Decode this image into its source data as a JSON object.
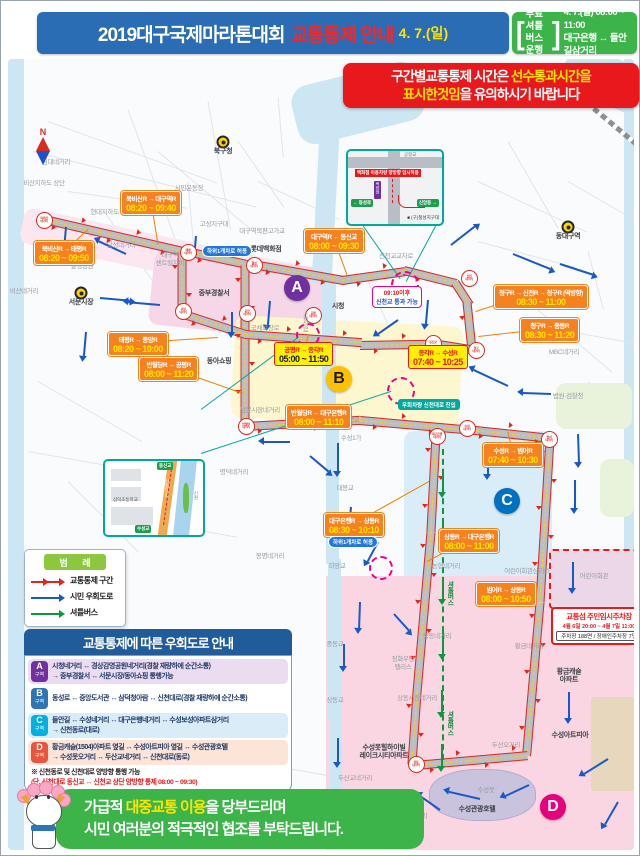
{
  "header": {
    "title": "2019대구국제마라톤대회",
    "subtitle": "교통통제 안내",
    "date": "4. 7.(일)",
    "shuttle": {
      "l1": "무료셔틀",
      "l2": "버스운행",
      "time": "4. 7.(일) 08:00 ~ 11:00",
      "route": "대구은행 ↔ 들안길삼거리",
      "bracket_open": "[",
      "bracket_close": "]"
    }
  },
  "notice": {
    "line1_pre": "구간별교통통제 시간은 ",
    "line1_hl": "선수통과시간을",
    "line2_hl": "표시한것임",
    "line2_post": "을 유의하시기 바랍니다"
  },
  "compass": {
    "n": "N",
    "s": "S"
  },
  "legend": {
    "title": "범 례",
    "items": [
      {
        "label": "교통통제 구간",
        "color": "#e0261f",
        "type": "double-arrow"
      },
      {
        "label": "시민 우회도로",
        "color": "#1a58c8",
        "type": "arrow"
      },
      {
        "label": "셔틀버스",
        "color": "#0a9a3c",
        "type": "arrow"
      }
    ]
  },
  "detour_box": {
    "title": "교통통제에 따른 우회도로 안내",
    "rows": [
      {
        "zone": "A",
        "zone_suffix": "구역",
        "badge": "#7030a0",
        "bg": "#ecdcf2",
        "lines": [
          "시청네거리 ↔ 경상감영공원네거리(경찰 재량하에 순간소통)",
          "→ 중부경찰서 ↔ 서문시장/동아쇼핑 통행가능"
        ]
      },
      {
        "zone": "B",
        "zone_suffix": "구역",
        "badge": "#2e75b6",
        "bg": "#ffffff",
        "lines": [
          "동성로 ↔ 중앙도서관 ↔ 삼덕청아람 ↔ 신천대로(경찰 재량하에 순간소통)"
        ]
      },
      {
        "zone": "C",
        "zone_suffix": "구역",
        "badge": "#00b0e0",
        "bg": "#d9ecf8",
        "lines": [
          "들안길 ↔ 수성네거리 ↔ 대구은행네거리 ↔ 수성보성아파트삼거리",
          "→ 신천동로(대로)"
        ]
      },
      {
        "zone": "D",
        "zone_suffix": "구역",
        "badge": "#e8553c",
        "bg": "#fde4d8",
        "lines": [
          "황금캐슬(1504)아파트 옆길 ↔ 수성아트피아 옆길 ↔ 수성관광호텔",
          "→ 수성못오거리 ↔ 두산교네거리 ↔ 신천대로(동로)"
        ]
      }
    ],
    "note_line1": "※ 신천동로 및 신천대로 양방향 통행 가능",
    "note_line2": "(단, 신천대로 동신교 ↔ 신천교 상단 양방향 통제 08:00 ~ 09:30)"
  },
  "footer": {
    "line1_pre": "가급적 ",
    "line1_hl": "대중교통 이용",
    "line1_post": "을 당부드리며",
    "line2": "시민 여러분의 적극적인 협조를 부탁드립니다."
  },
  "map": {
    "zone_letters": [
      {
        "letter": "A",
        "x": 289,
        "y": 287,
        "bg": "#7030a0",
        "fg": "#ffffff"
      },
      {
        "letter": "B",
        "x": 331,
        "y": 378,
        "bg": "#ffc000",
        "fg": "#1a1a1a"
      },
      {
        "letter": "C",
        "x": 499,
        "y": 500,
        "bg": "#0070c0",
        "fg": "#ffffff"
      },
      {
        "letter": "D",
        "x": 545,
        "y": 806,
        "bg": "#e6007e",
        "fg": "#ffffff"
      }
    ],
    "time_labels": [
      {
        "route": "북비산R → 대구역R",
        "time": "08:20 ~ 09:40",
        "x": 113,
        "y": 190,
        "v": "o",
        "tx": 150,
        "ty": 243
      },
      {
        "route": "북비산R → 태평R",
        "time": "08:20 ~ 09:50",
        "x": 26,
        "y": 240,
        "v": "o",
        "tx": 80,
        "ty": 228
      },
      {
        "route": "대구역R ← 동신교",
        "time": "08:00 ~ 09:30",
        "x": 296,
        "y": 228,
        "v": "o",
        "tx": 340,
        "ty": 276
      },
      {
        "route": "태평R → 중앙R",
        "time": "08:20 ~ 10:00",
        "x": 100,
        "y": 331,
        "v": "o",
        "tx": 210,
        "ty": 336
      },
      {
        "route": "반월당R → 공평R",
        "time": "08:00 ~ 11:20",
        "x": 131,
        "y": 356,
        "v": "o",
        "tx": 235,
        "ty": 392
      },
      {
        "route": "공평R → 종각R",
        "time": "05:00 ~ 11:50",
        "x": 266,
        "y": 341,
        "v": "y",
        "tx": 300,
        "ty": 334
      },
      {
        "route": "종각R → 수성R",
        "time": "07:40 ~ 10:25",
        "x": 400,
        "y": 344,
        "v": "y y2",
        "tx": 420,
        "ty": 341
      },
      {
        "route": "청구R → 신천R → 청구R (역방향)",
        "time": "08:30 ~ 11:00",
        "x": 486,
        "y": 284,
        "v": "o",
        "tx": 468,
        "ty": 310
      },
      {
        "route": "청구R → 중동R",
        "time": "08:30 ~ 11:20",
        "x": 512,
        "y": 317,
        "v": "o",
        "tx": 470,
        "ty": 335
      },
      {
        "route": "반월당R ← 대구은행R",
        "time": "08:00 ~ 11:10",
        "x": 278,
        "y": 404,
        "v": "o",
        "tx": 320,
        "ty": 419
      },
      {
        "route": "수성R → 범어R",
        "time": "07:40 ~ 10:30",
        "x": 475,
        "y": 442,
        "v": "o",
        "tx": 500,
        "ty": 431
      },
      {
        "route": "대구은행R → 상동R",
        "time": "08:30 ~ 10:10",
        "x": 316,
        "y": 512,
        "v": "o",
        "tx": 421,
        "ty": 480
      },
      {
        "route": "상동R → 대구은행R",
        "time": "08:00 ~ 11:00",
        "x": 431,
        "y": 528,
        "v": "o",
        "tx": 419,
        "ty": 560
      },
      {
        "route": "범어R → 상동R",
        "time": "08:00 ~ 10:50",
        "x": 468,
        "y": 581,
        "v": "o",
        "tx": 528,
        "ty": 601
      }
    ],
    "special_labels": [
      {
        "kind": "pill-blue",
        "text": "하위1개차로 허용",
        "x": 194,
        "y": 244
      },
      {
        "kind": "pill-blue",
        "text": "하위1개차로 허용",
        "x": 320,
        "y": 535
      },
      {
        "kind": "box-teal",
        "text": "우회차량 신천대로 진입",
        "x": 390,
        "y": 398
      }
    ],
    "pass_box": {
      "line1": "09:10이후",
      "line2": "신천교 통과 가능",
      "x": 364,
      "y": 285
    },
    "parking": {
      "title": "교통섬 주민임시주차장",
      "period": "4월 6일 20:00 ~ 4월 7일 11:00",
      "capacity": "주차장 188면 / 장애인주차장 7면",
      "x": 543,
      "y": 606
    },
    "junctions": [
      {
        "n": "북비산\n네거리",
        "x": 35,
        "y": 218
      },
      {
        "n": "태평\n네거리",
        "x": 179,
        "y": 250
      },
      {
        "n": "칠성\n네거리",
        "x": 245,
        "y": 263
      },
      {
        "n": "서성\n네거리",
        "x": 174,
        "y": 309
      },
      {
        "n": "중앙\n네거리",
        "x": 238,
        "y": 311
      },
      {
        "n": "공평\n네거리",
        "x": 304,
        "y": 313
      },
      {
        "n": "반월당\n네거리",
        "x": 237,
        "y": 424
      },
      {
        "n": "동신교",
        "x": 424,
        "y": 341
      },
      {
        "n": "청구\n네거리",
        "x": 467,
        "y": 348
      },
      {
        "n": "신천\n네거리",
        "x": 460,
        "y": 276
      },
      {
        "n": "수성\n네거리",
        "x": 458,
        "y": 426
      },
      {
        "n": "대구은행\n네거리",
        "x": 428,
        "y": 434
      },
      {
        "n": "범어\n네거리",
        "x": 540,
        "y": 437
      },
      {
        "n": "상동\n네거리",
        "x": 407,
        "y": 762
      }
    ],
    "magenta_circles": [
      {
        "x": 395,
        "y": 282,
        "r": 12
      },
      {
        "x": 298,
        "y": 332,
        "r": 10
      },
      {
        "x": 391,
        "y": 388,
        "r": 12
      },
      {
        "x": 371,
        "y": 565,
        "r": 10
      }
    ],
    "places": [
      {
        "t": "북구청",
        "x": 215,
        "y": 151,
        "v": "d",
        "icon": true
      },
      {
        "t": "동대구역",
        "x": 560,
        "y": 236,
        "v": "d",
        "icon": true
      },
      {
        "t": "서문시장",
        "x": 73,
        "y": 302,
        "v": "d",
        "icon": true
      },
      {
        "t": "시청",
        "x": 330,
        "y": 306,
        "v": "d"
      },
      {
        "t": "원대네거리",
        "x": 48,
        "y": 162,
        "v": "g"
      },
      {
        "t": "비산지하도 상단",
        "x": 36,
        "y": 183,
        "v": "g"
      },
      {
        "t": "현대지하도 상단",
        "x": 103,
        "y": 212,
        "v": "g"
      },
      {
        "t": "달성네거리",
        "x": 113,
        "y": 245,
        "v": "g"
      },
      {
        "t": "달성공원",
        "x": 74,
        "y": 266,
        "v": "g"
      },
      {
        "t": "비산네거리",
        "x": 16,
        "y": 291,
        "v": "g"
      },
      {
        "t": "시민운동장",
        "x": 181,
        "y": 188,
        "v": "g"
      },
      {
        "t": "고성지구대",
        "x": 206,
        "y": 224,
        "v": "g"
      },
      {
        "t": "대구역북편고가교",
        "x": 254,
        "y": 231,
        "v": "g"
      },
      {
        "t": "롯데백화점",
        "x": 258,
        "y": 249,
        "v": "d"
      },
      {
        "t": "대구역\n센트럴자이",
        "x": 162,
        "y": 259,
        "v": "g"
      },
      {
        "t": "중부경찰서",
        "x": 206,
        "y": 293,
        "v": "d"
      },
      {
        "t": "동아쇼핑",
        "x": 211,
        "y": 361,
        "v": "d"
      },
      {
        "t": "국채보상로",
        "x": 257,
        "y": 328,
        "v": "g"
      },
      {
        "t": "동성로",
        "x": 296,
        "y": 322,
        "v": "v"
      },
      {
        "t": "남문시장네거리",
        "x": 252,
        "y": 410,
        "v": "g"
      },
      {
        "t": "명덕네거리",
        "x": 226,
        "y": 472,
        "v": "g"
      },
      {
        "t": "봉명네거리",
        "x": 262,
        "y": 556,
        "v": "g"
      },
      {
        "t": "신천교교차로",
        "x": 388,
        "y": 256,
        "v": "g"
      },
      {
        "t": "MBC네거리",
        "x": 556,
        "y": 352,
        "v": "g"
      },
      {
        "t": "법원·검찰청",
        "x": 560,
        "y": 396,
        "v": "g"
      },
      {
        "t": "수성교",
        "x": 343,
        "y": 420,
        "v": "g"
      },
      {
        "t": "수성1가",
        "x": 343,
        "y": 438,
        "v": "g"
      },
      {
        "t": "대봉교",
        "x": 337,
        "y": 488,
        "v": "g"
      },
      {
        "t": "희망교",
        "x": 329,
        "y": 566,
        "v": "g"
      },
      {
        "t": "중동교",
        "x": 327,
        "y": 644,
        "v": "g"
      },
      {
        "t": "중동네거리",
        "x": 429,
        "y": 636,
        "v": "g"
      },
      {
        "t": "농협네거리",
        "x": 438,
        "y": 566,
        "v": "g"
      },
      {
        "t": "어린이회관삼거리",
        "x": 519,
        "y": 571,
        "v": "g"
      },
      {
        "t": "어린이회관",
        "x": 586,
        "y": 576,
        "v": "g"
      },
      {
        "t": "황금네거리",
        "x": 521,
        "y": 646,
        "v": "g"
      },
      {
        "t": "황금캐슬\n아파트",
        "x": 561,
        "y": 676,
        "v": "d"
      },
      {
        "t": "정화우방\n팰리스",
        "x": 395,
        "y": 663,
        "v": "g"
      },
      {
        "t": "상동교",
        "x": 327,
        "y": 700,
        "v": "g"
      },
      {
        "t": "상동시장네거리",
        "x": 409,
        "y": 698,
        "v": "g"
      },
      {
        "t": "두산오거리",
        "x": 498,
        "y": 745,
        "v": "g"
      },
      {
        "t": "수성못힐하이빌\n레이크시티아파트",
        "x": 376,
        "y": 752,
        "v": "d"
      },
      {
        "t": "두산교네거리",
        "x": 347,
        "y": 778,
        "v": "g"
      },
      {
        "t": "수성못오거리",
        "x": 402,
        "y": 816,
        "v": "g"
      },
      {
        "t": "수성못",
        "x": 478,
        "y": 790,
        "v": "g"
      },
      {
        "t": "수성관광호텔",
        "x": 469,
        "y": 809,
        "v": "d"
      },
      {
        "t": "수성아트피아",
        "x": 562,
        "y": 735,
        "v": "d"
      },
      {
        "t": "셔틀버스",
        "x": 441,
        "y": 592,
        "v": "vg"
      },
      {
        "t": "셔틀버스",
        "x": 441,
        "y": 722,
        "v": "vg"
      }
    ],
    "roads": [
      [
        32,
        216,
        152,
        13
      ],
      [
        178,
        249,
        69,
        12
      ],
      [
        245,
        262,
        93,
        10
      ],
      [
        334,
        278,
        65,
        -8
      ],
      [
        396,
        268,
        54,
        14
      ],
      [
        447,
        280,
        27,
        57
      ],
      [
        459,
        300,
        48,
        84
      ],
      [
        424,
        341,
        45,
        9
      ],
      [
        352,
        343,
        74,
        -1
      ],
      [
        237,
        263,
        162,
        90
      ],
      [
        237,
        332,
        117,
        4
      ],
      [
        174,
        250,
        62,
        90
      ],
      [
        173,
        311,
        68,
        18
      ],
      [
        236,
        424,
        116,
        -3
      ],
      [
        352,
        418,
        107,
        5
      ],
      [
        458,
        427,
        85,
        6
      ],
      [
        542,
        436,
        164,
        93.5
      ],
      [
        532,
        600,
        154,
        95
      ],
      [
        407,
        763,
        113,
        -5
      ],
      [
        409,
        690,
        72,
        94
      ],
      [
        423,
        530,
        161,
        95
      ],
      [
        428,
        433,
        97,
        93
      ]
    ],
    "shuttle_road": [
      435,
      447,
      311,
      90
    ],
    "blue_arrows": [
      [
        58,
        225,
        95,
        24
      ],
      [
        118,
        252,
        205,
        30
      ],
      [
        92,
        296,
        5,
        30
      ],
      [
        152,
        303,
        185,
        32
      ],
      [
        188,
        234,
        95,
        18
      ],
      [
        262,
        299,
        95,
        24
      ],
      [
        224,
        310,
        90,
        20
      ],
      [
        443,
        243,
        -38,
        30
      ],
      [
        505,
        252,
        22,
        40
      ],
      [
        552,
        262,
        18,
        34
      ],
      [
        420,
        298,
        95,
        24
      ],
      [
        390,
        318,
        145,
        24
      ],
      [
        500,
        384,
        205,
        38
      ],
      [
        543,
        392,
        182,
        28
      ],
      [
        570,
        432,
        88,
        28
      ],
      [
        567,
        478,
        90,
        28
      ],
      [
        330,
        441,
        90,
        28
      ],
      [
        302,
        454,
        40,
        24
      ],
      [
        343,
        505,
        95,
        28
      ],
      [
        352,
        600,
        92,
        26
      ],
      [
        386,
        612,
        48,
        22
      ],
      [
        561,
        690,
        90,
        26
      ],
      [
        600,
        757,
        148,
        28
      ],
      [
        472,
        797,
        193,
        32
      ],
      [
        432,
        808,
        215,
        24
      ],
      [
        521,
        783,
        155,
        26
      ],
      [
        330,
        736,
        90,
        24
      ],
      [
        336,
        642,
        90,
        22
      ],
      [
        370,
        540,
        118,
        22
      ],
      [
        282,
        440,
        180,
        26
      ],
      [
        78,
        330,
        95,
        24
      ],
      [
        565,
        560,
        90,
        26
      ],
      [
        610,
        800,
        120,
        26
      ],
      [
        480,
        452,
        90,
        20
      ]
    ],
    "green_arrows": [
      [
        435,
        468,
        90,
        22
      ],
      [
        435,
        520,
        90,
        22
      ],
      [
        435,
        575,
        90,
        22
      ],
      [
        435,
        630,
        90,
        22
      ],
      [
        434,
        688,
        90,
        22
      ],
      [
        434,
        742,
        90,
        22
      ]
    ],
    "teal_lines": [
      [
        352,
        220,
        70,
        55
      ],
      [
        430,
        220,
        68,
        118
      ],
      [
        193,
        408,
        121,
        -36.6
      ],
      [
        193,
        452,
        200,
        -18.1
      ]
    ],
    "insets": {
      "junction_detail": {
        "road_label": "공항교",
        "banner": "백화점 이용차량 양방향 임시허용",
        "building": "백화점",
        "sign_left": "← 동성로",
        "sign_right": "신암동 →",
        "note": "■ (구)칠성지구대"
      },
      "bridge_detail": {
        "school": "삼덕초등학교",
        "road": "신천대로",
        "river": "신천",
        "sign_top": "동신교",
        "sign_bottom": "수성교"
      }
    }
  }
}
